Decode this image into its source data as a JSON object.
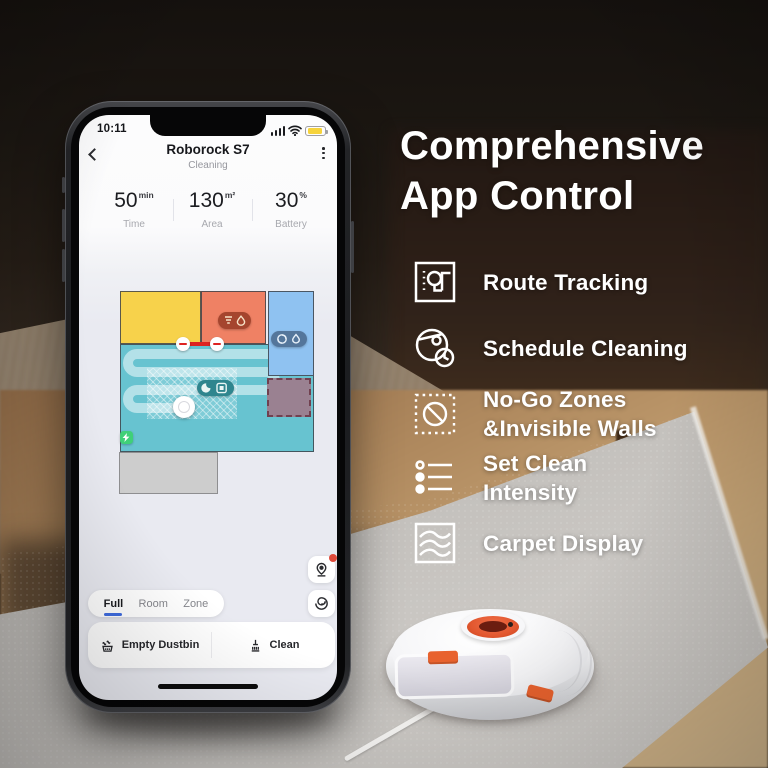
{
  "right_panel": {
    "heading": {
      "line1": "Comprehensive",
      "line2": "App Control"
    },
    "features": [
      {
        "icon": "route-tracking-icon",
        "line1": "Route Tracking",
        "line2": ""
      },
      {
        "icon": "schedule-cleaning-icon",
        "line1": "Schedule Cleaning",
        "line2": ""
      },
      {
        "icon": "no-go-zones-icon",
        "line1": "No-Go Zones",
        "line2": "&Invisible Walls"
      },
      {
        "icon": "set-clean-intensity-icon",
        "line1": "Set Clean",
        "line2": "Intensity"
      },
      {
        "icon": "carpet-display-icon",
        "line1": "Carpet Display",
        "line2": ""
      }
    ]
  },
  "phone": {
    "status_bar": {
      "time": "10:11",
      "icons": [
        "signal-bars-icon",
        "wifi-icon",
        "battery-low-yellow-icon"
      ]
    },
    "header": {
      "title": "Roborock S7",
      "subtitle": "Cleaning",
      "left_icon": "chevron-back-icon",
      "right_icon": "kebab-menu-icon"
    },
    "stats": [
      {
        "value": "50",
        "unit": "min",
        "label": "Time"
      },
      {
        "value": "130",
        "unit": "m²",
        "label": "Area"
      },
      {
        "value": "30",
        "unit": "%",
        "label": "Battery"
      }
    ],
    "map": {
      "rooms": [
        {
          "name": "yellow-room",
          "color": "#f7d24b"
        },
        {
          "name": "orange-room",
          "color": "#ef8164"
        },
        {
          "name": "blue-room",
          "color": "#8fc2f1"
        },
        {
          "name": "teal-room",
          "color": "#67c3d0"
        },
        {
          "name": "unmapped-gray-room",
          "color": "#cdcdcd"
        }
      ],
      "overlays": {
        "virtual_wall_color": "#de2321",
        "no_go_zone_fill": "#9a8191",
        "no_go_zone_border": "#71404f",
        "dock_color": "#3fd078",
        "clean_path_color": "rgba(255,255,255,0.5)"
      },
      "badges": [
        "suction-drop-badge",
        "cyclone-drop-badge",
        "moon-zone-badge"
      ]
    },
    "map_controls": [
      {
        "icon": "robot-locate-pin-icon",
        "notification": true
      },
      {
        "icon": "fan-swirl-icon",
        "notification": false
      }
    ],
    "tabs": [
      {
        "label": "Full",
        "active": true
      },
      {
        "label": "Room",
        "active": false
      },
      {
        "label": "Zone",
        "active": false
      }
    ],
    "actions": {
      "empty_dustbin": "Empty Dustbin",
      "clean": "Clean",
      "empty_dustbin_icon": "dustbin-waves-icon",
      "clean_icon": "broom-icon"
    },
    "accent_colors": {
      "tab_underline": "#3f6ce0",
      "notification_red": "#e04a3a",
      "battery_yellow": "#f6d33c"
    }
  },
  "photo": {
    "subject": "roborock-s7-robot-vacuum-on-carpet",
    "robot_accent": "#e2572f"
  }
}
